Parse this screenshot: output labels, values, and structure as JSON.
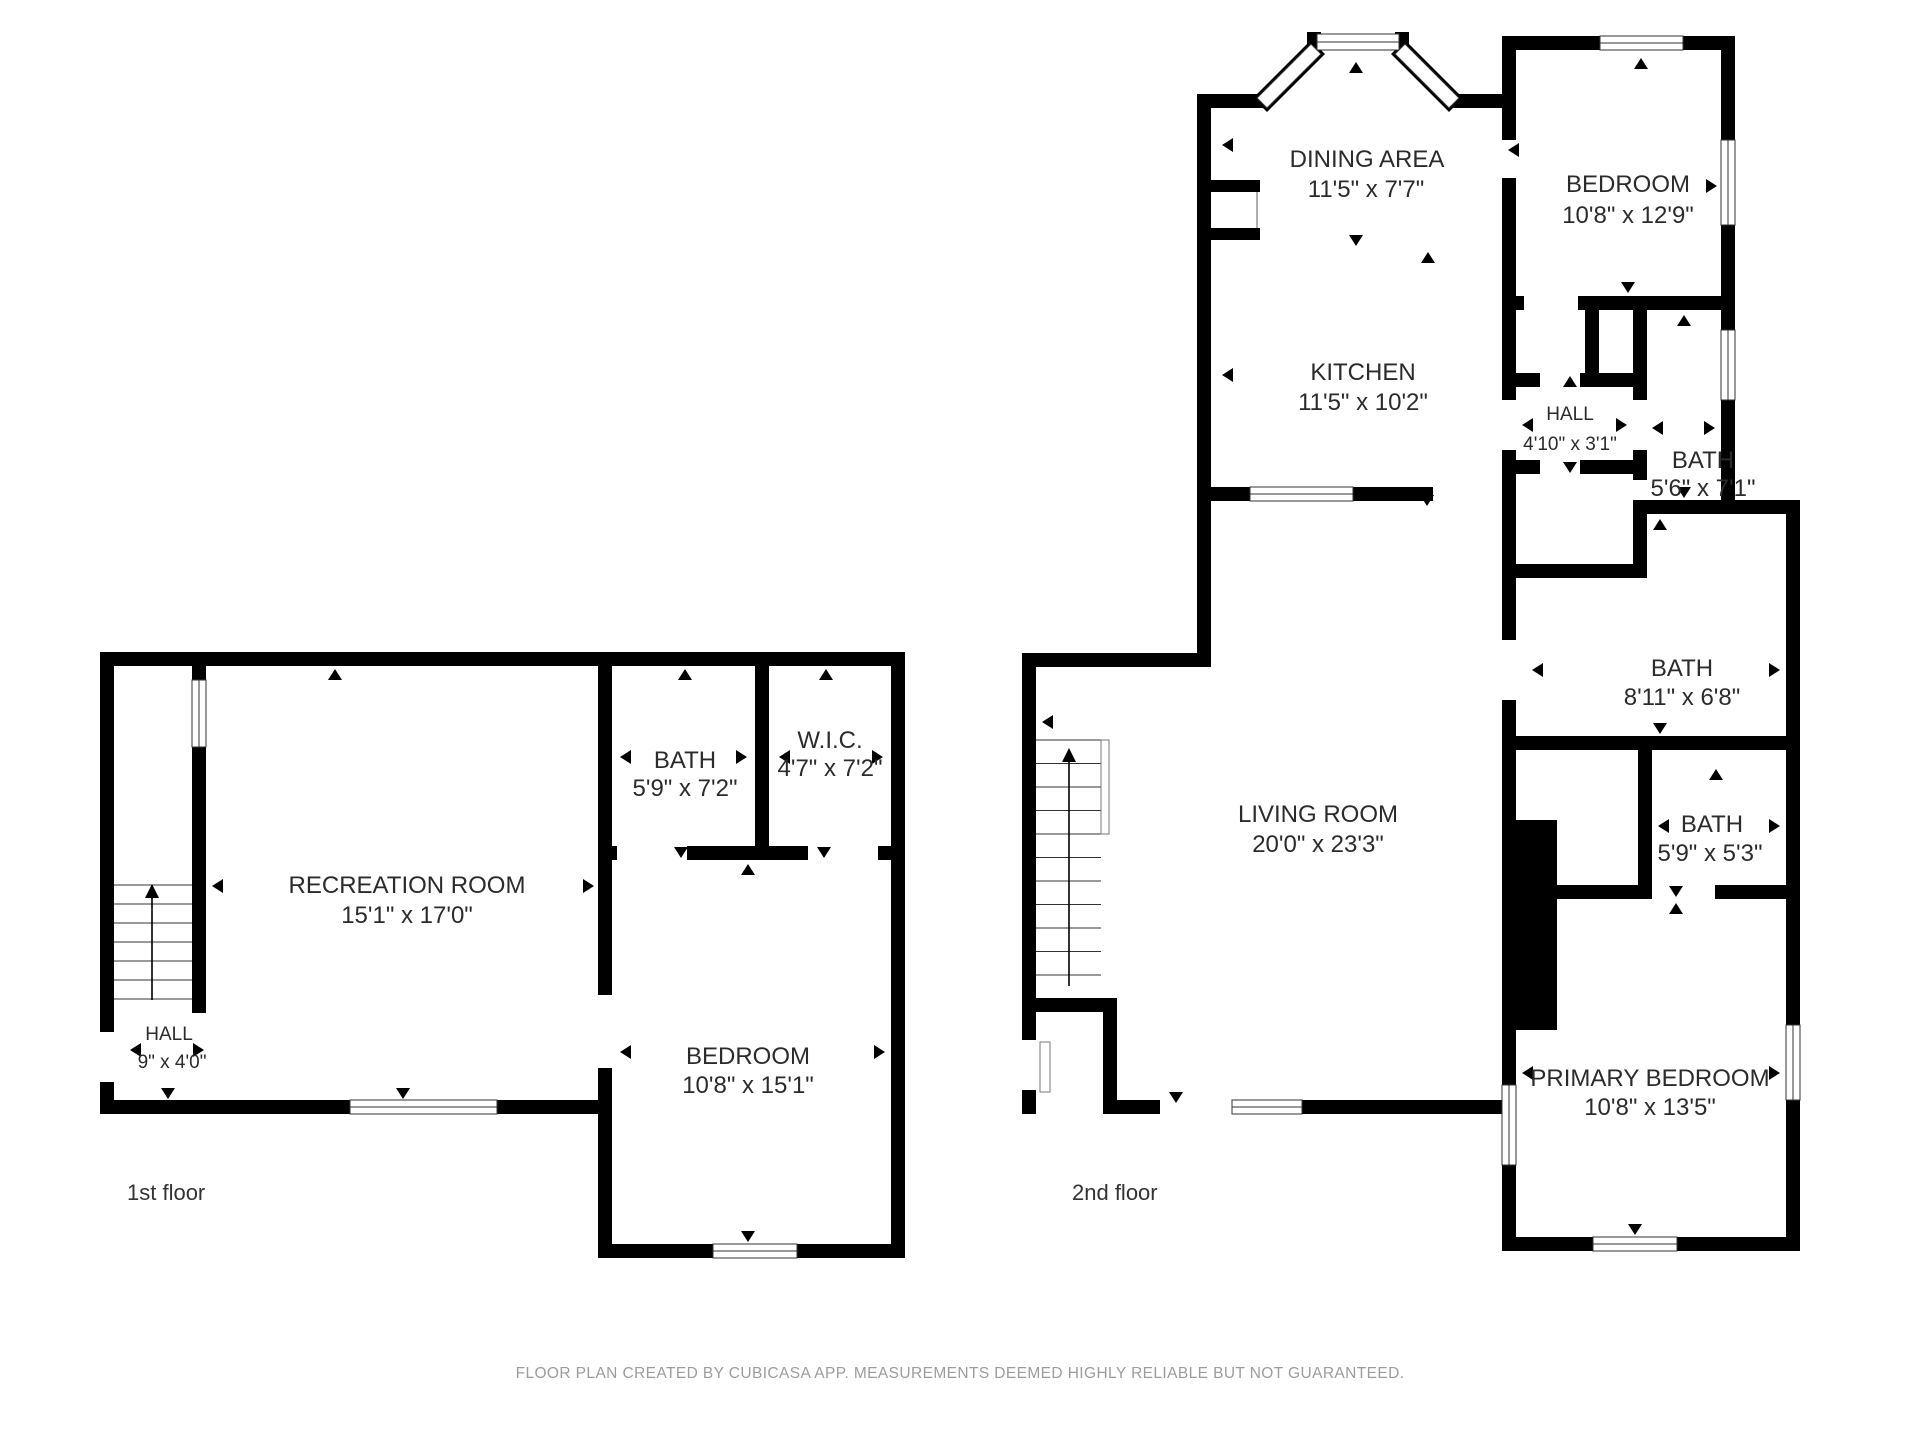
{
  "footer": {
    "disclaimer": "FLOOR PLAN CREATED BY CUBICASA APP. MEASUREMENTS DEEMED HIGHLY RELIABLE BUT NOT GUARANTEED."
  },
  "floor1": {
    "label": "1st floor",
    "rooms": {
      "recreation": {
        "name": "RECREATION ROOM",
        "dims": "15'1\" x 17'0\""
      },
      "bath": {
        "name": "BATH",
        "dims": "5'9\" x 7'2\""
      },
      "wic": {
        "name": "W.I.C.",
        "dims": "4'7\" x 7'2\""
      },
      "bedroom": {
        "name": "BEDROOM",
        "dims": "10'8\" x 15'1\""
      },
      "hall": {
        "name": "HALL",
        "dims": "9\" x 4'0\""
      }
    }
  },
  "floor2": {
    "label": "2nd floor",
    "rooms": {
      "dining": {
        "name": "DINING AREA",
        "dims": "11'5\" x 7'7\""
      },
      "kitchen": {
        "name": "KITCHEN",
        "dims": "11'5\" x 10'2\""
      },
      "bedroom": {
        "name": "BEDROOM",
        "dims": "10'8\" x 12'9\""
      },
      "hall": {
        "name": "HALL",
        "dims": "4'10\" x 3'1\""
      },
      "bath1": {
        "name": "BATH",
        "dims": "5'6\" x 7'1\""
      },
      "bath2": {
        "name": "BATH",
        "dims": "8'11\" x 6'8\""
      },
      "bath3": {
        "name": "BATH",
        "dims": "5'9\" x 5'3\""
      },
      "living": {
        "name": "LIVING ROOM",
        "dims": "20'0\" x 23'3\""
      },
      "primary": {
        "name": "PRIMARY BEDROOM",
        "dims": "10'8\" x 13'5\""
      }
    }
  }
}
